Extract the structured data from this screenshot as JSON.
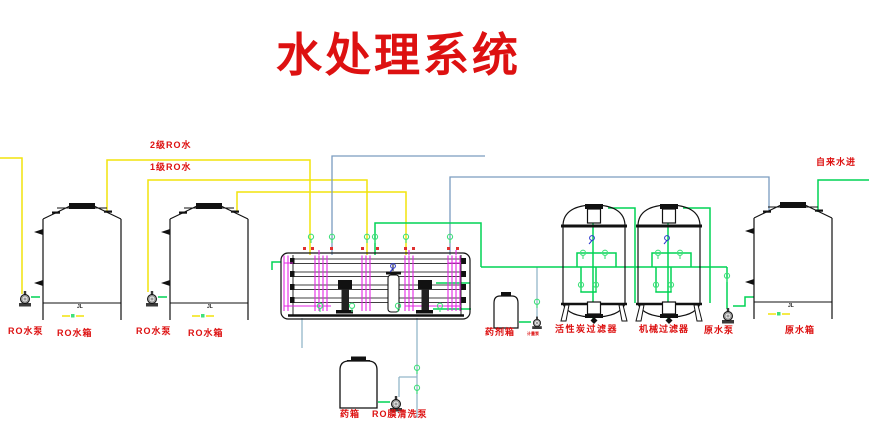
{
  "title": "水处理系统",
  "labels": {
    "line_stage2": "2级RO水",
    "line_stage1": "1级RO水",
    "tap_in": "自来水进",
    "ro_pump_1": "RO水泵",
    "ro_tank_1": "RO水箱",
    "ro_pump_2": "RO水泵",
    "ro_tank_2": "RO水箱",
    "dosing_tank": "药剂箱",
    "dosing_pump": "计量泵",
    "carbon_filter": "活性炭过滤器",
    "mech_filter": "机械过滤器",
    "raw_pump": "原水泵",
    "raw_tank": "原水箱",
    "chem_tank": "药箱",
    "clean_pump": "RO膜清洗泵",
    "drain_1": "JL",
    "drain_2": "JL",
    "drain_3": "JL"
  },
  "colors": {
    "pipe_yellow": "#f2e40c",
    "pipe_green": "#00d455",
    "valve_green": "#3fe07a",
    "pipe_steel_blue": "#7a9cbf",
    "pipe_clean_blue": "#93b7c9",
    "pipe_magenta": "#e326e3",
    "label_red": "#dd1111",
    "gauge_blue": "#2a35cc",
    "equipment_black": "#111111"
  }
}
